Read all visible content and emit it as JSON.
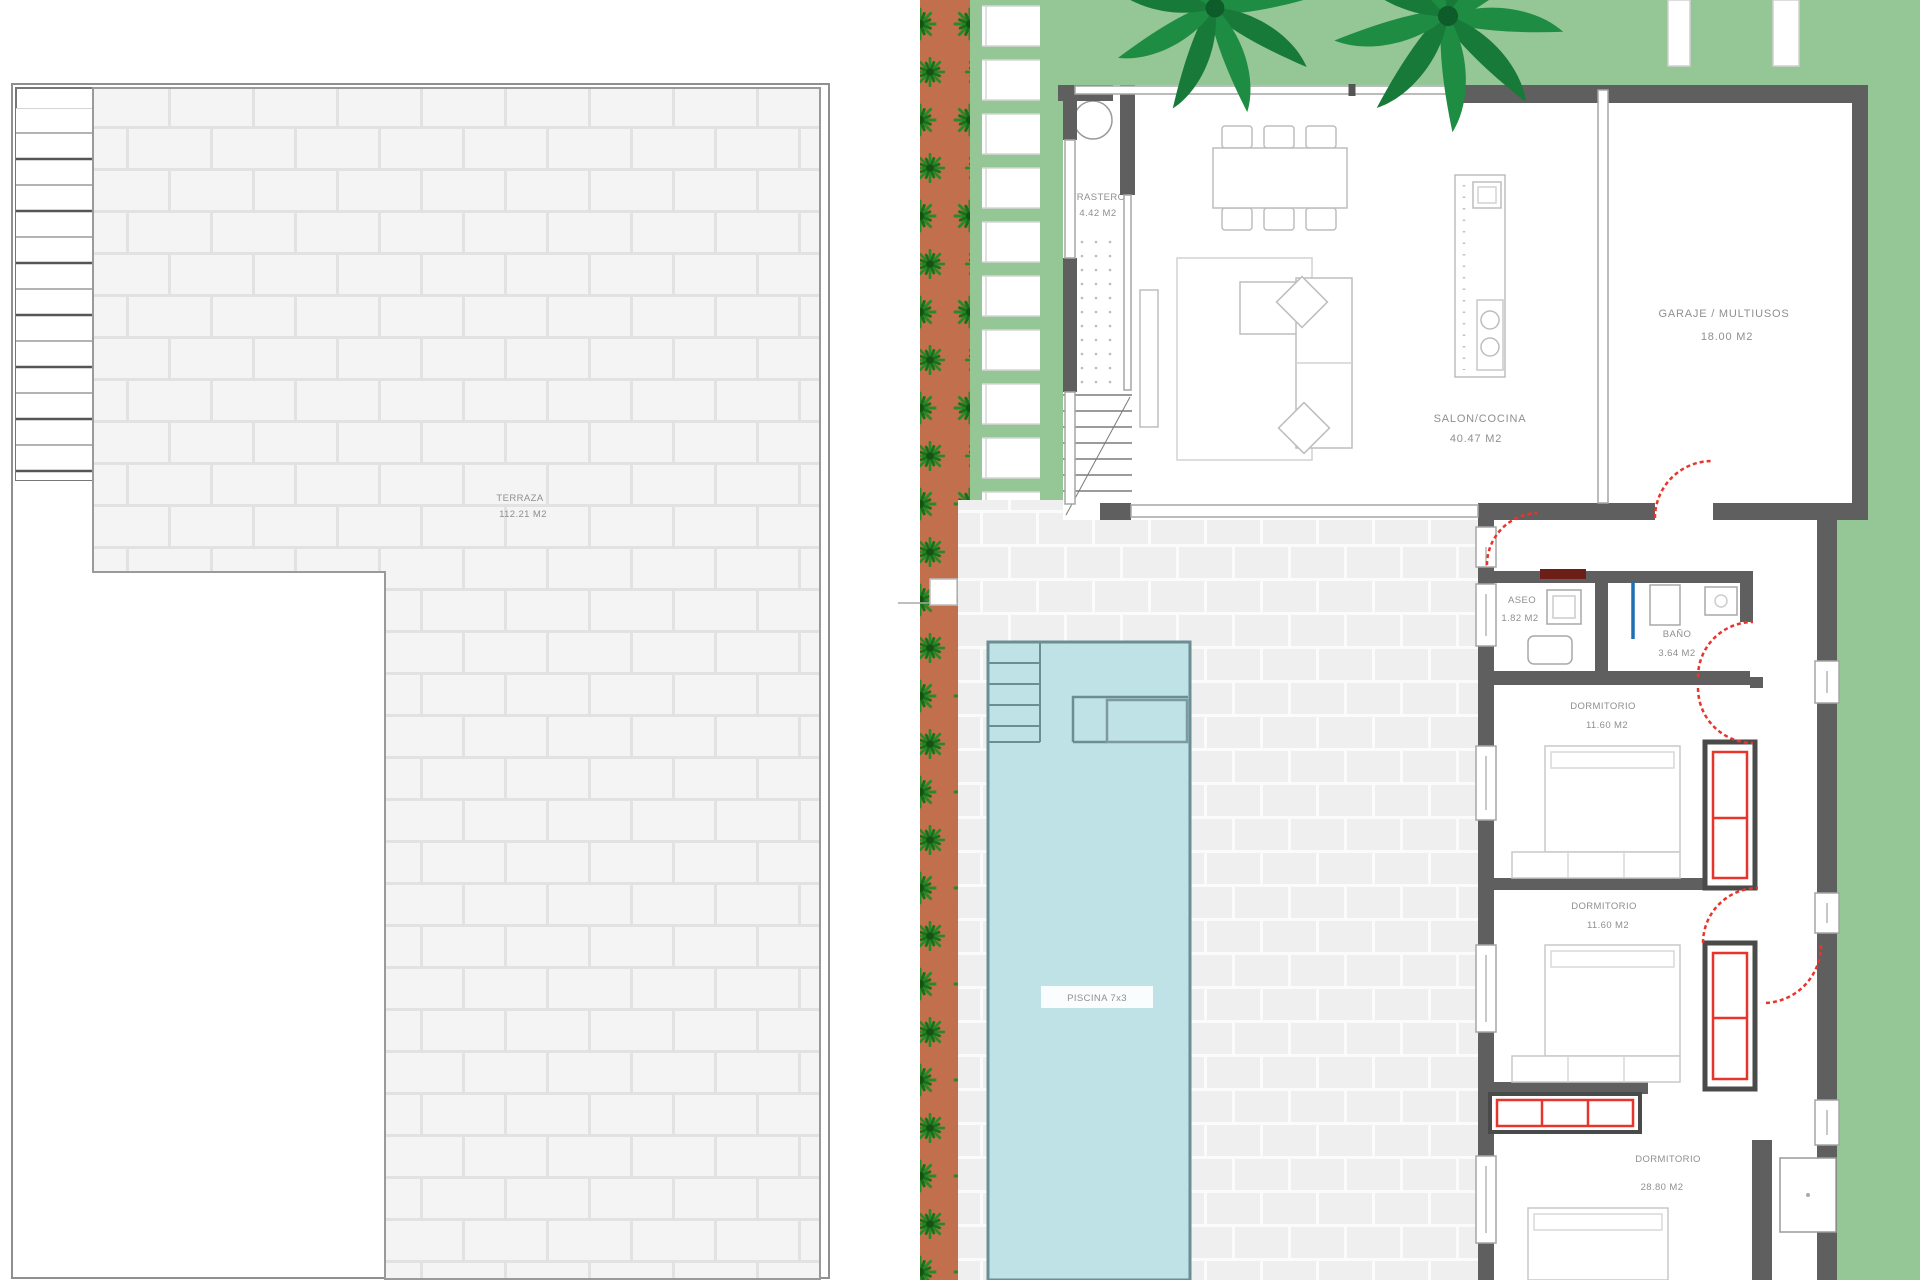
{
  "rooms": {
    "terraza": {
      "name": "TERRAZA",
      "area": "112.21 M2"
    },
    "trastero": {
      "name": "TRASTERO",
      "area": "4.42 M2"
    },
    "salon_cocina": {
      "name": "SALON/COCINA",
      "area": "40.47 M2"
    },
    "garaje_multiusos": {
      "name": "GARAJE / MULTIUSOS",
      "area": "18.00 M2"
    },
    "aseo": {
      "name": "ASEO",
      "area": "1.82 M2"
    },
    "bano": {
      "name": "BAÑO",
      "area": "3.64 M2"
    },
    "dormitorio_1": {
      "name": "DORMITORIO",
      "area": "11.60 M2"
    },
    "dormitorio_2": {
      "name": "DORMITORIO",
      "area": "11.60 M2"
    },
    "dormitorio_3": {
      "name": "DORMITORIO",
      "area": "28.80 M2"
    },
    "piscina": {
      "name": "PISCINA 7x3"
    }
  },
  "colors": {
    "wall": "#5f5f5f",
    "door_red": "#e8352b",
    "pool_water": "#bfe2e6",
    "pool_line": "#6b8d94",
    "grass": "#94c795",
    "planter_soil": "#c26f4e",
    "shower_blue": "#1f6fb5",
    "label_text": "#8f8f8f"
  }
}
